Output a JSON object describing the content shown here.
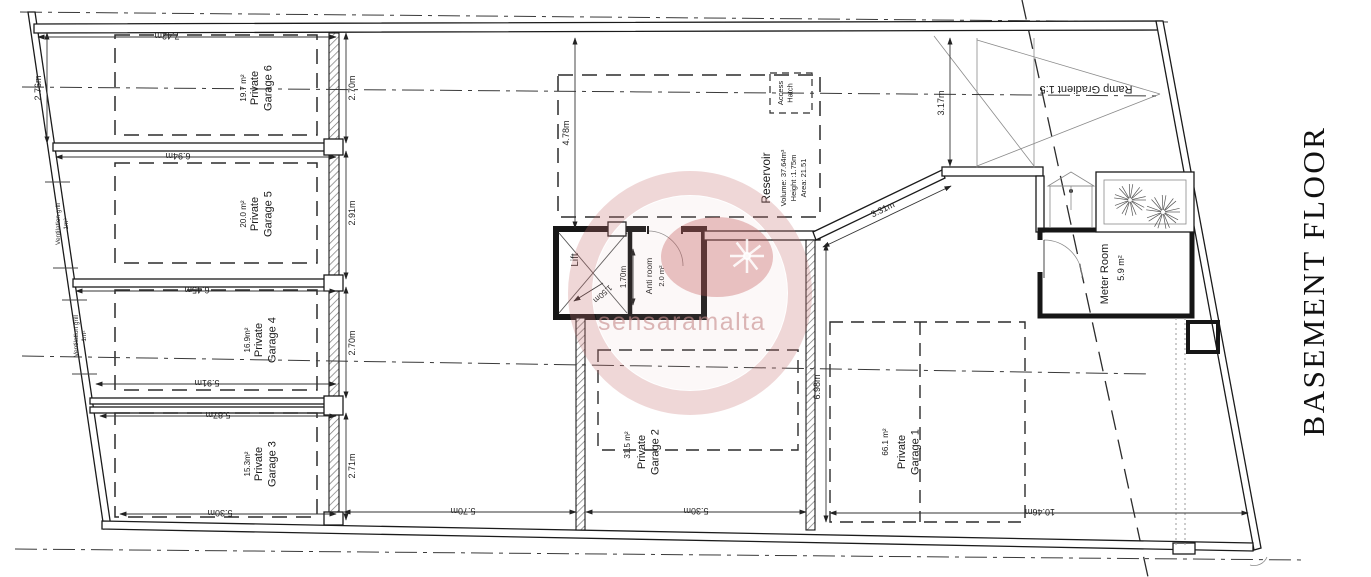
{
  "title": {
    "label": "BASEMENT FLOOR"
  },
  "watermark": {
    "text": "sensaramalta"
  },
  "rooms": {
    "garage6": {
      "name": "Private Garage 6",
      "area": "19.7 m²"
    },
    "garage5": {
      "name": "Private Garage 5",
      "area": "20.0 m²"
    },
    "garage4": {
      "name": "Private Garage 4",
      "area": "16.9m²"
    },
    "garage3": {
      "name": "Private Garage 3",
      "area": "15.3m²"
    },
    "garage2": {
      "name": "Private Garage 2",
      "area": "31.5 m²"
    },
    "garage1": {
      "name": "Private Garage 1",
      "area": "66.1 m²"
    },
    "lift": {
      "name": "Lift"
    },
    "anti_room": {
      "name": "Anti room",
      "area": "2.0 m²"
    },
    "meter_room": {
      "name": "Meter Room",
      "area": "5.9 m²"
    },
    "reservoir": {
      "name": "Reservoir",
      "volume": "Volume: 37.64m³",
      "height": "Height :1.75m",
      "area": "Area: 21.51"
    },
    "access_hatch": {
      "name": "Access Hatch"
    },
    "ramp": {
      "label": "Ramp Gradient 1:5"
    }
  },
  "annotations": {
    "ventilation_grill_a": "Ventilation grill 1m²",
    "ventilation_grill_b": "Ventilation grill 1m²"
  },
  "dimensions": {
    "garage6_length": "7.42m",
    "garage6_width_left": "2.76m",
    "garage6_width_right": "2.70m",
    "garage5_length": "6.94m",
    "garage5_width": "2.91m",
    "garage4_length_top": "6.45m",
    "garage4_length_bottom": "5.91m",
    "garage4_width": "2.70m",
    "garage3_length_top": "5.87m",
    "garage3_length_bottom": "5.30m",
    "garage3_width": "2.71m",
    "driveway_width": "5.70m",
    "garage2_length": "5.30m",
    "garage2_depth": "6.98m",
    "garage1_length": "10.46m",
    "reservoir_depth": "4.78m",
    "ramp_width": "3.17m",
    "splay_wall": "3.31m",
    "lift_diag": "1.50m",
    "anti_room_width": "1.70m"
  }
}
